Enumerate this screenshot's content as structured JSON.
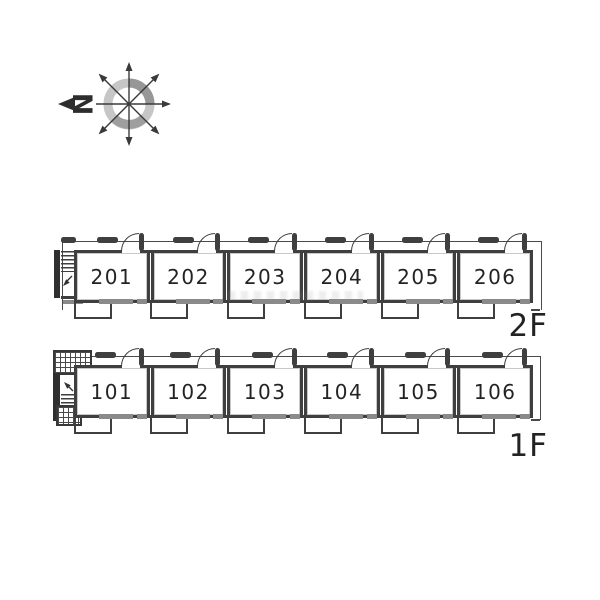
{
  "compass": {
    "north_label": "N"
  },
  "floor_plan": {
    "floors": [
      {
        "label": "2F",
        "rooms": [
          "201",
          "202",
          "203",
          "204",
          "205",
          "206"
        ]
      },
      {
        "label": "1F",
        "rooms": [
          "101",
          "102",
          "103",
          "104",
          "105",
          "106"
        ]
      }
    ]
  },
  "colors": {
    "wall": "#3f3f3f",
    "window": "#8a8a8a",
    "outline": "#4a4a4a",
    "compass_ring_light": "#c6c6c6",
    "compass_ring_dark": "#979797",
    "text": "#232323"
  }
}
